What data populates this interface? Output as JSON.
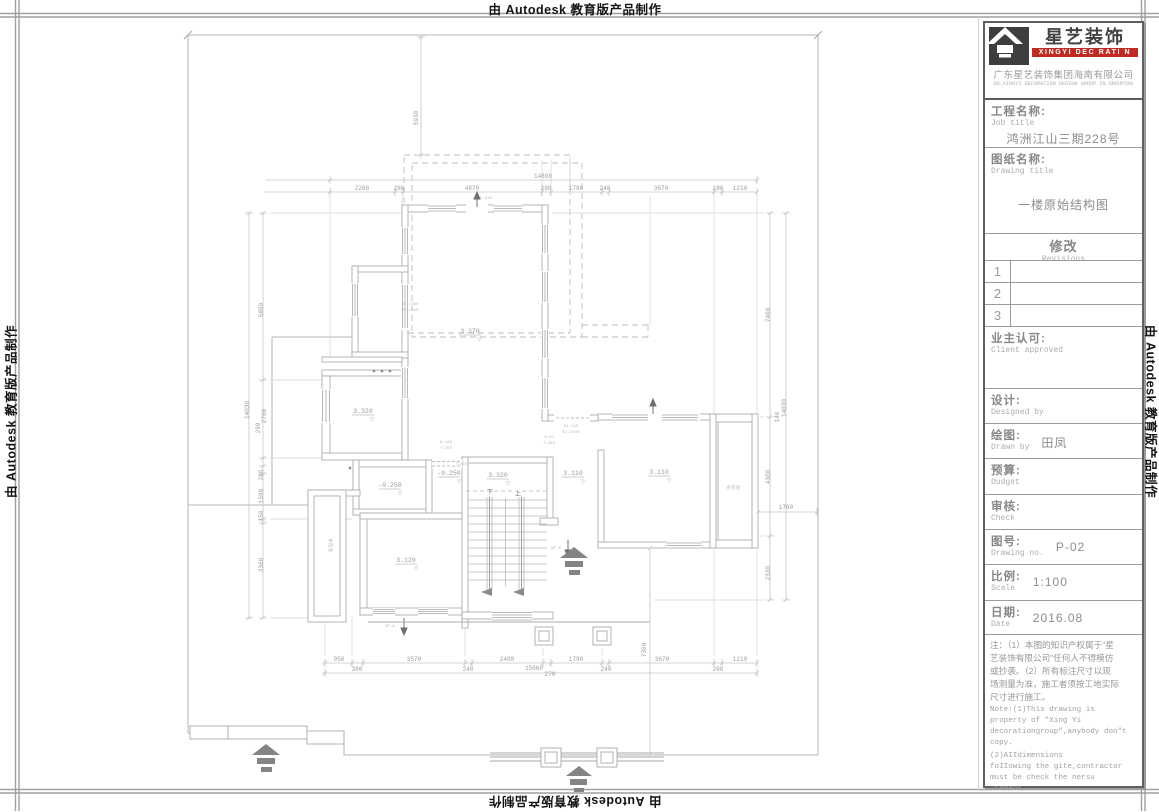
{
  "edge_marks": {
    "top": "由 Autodesk 教育版产品制作",
    "bottom": "由 Autodesk 教育版产品制作",
    "left": "由 Autodesk 教育版产品制作",
    "right": "由 Autodesk 教育版产品制作"
  },
  "colors": {
    "brand_red": "#bf2b23",
    "cad_line": "#b4b4b4",
    "dim_text": "#9c9c9c",
    "frame_dark": "#5f5f5f"
  },
  "title_block": {
    "logo": {
      "icon": "house-roof-icon",
      "brand_cn": "星艺装饰",
      "brand_en": "XINGYI DEC RATI N",
      "company_cn": "广东星艺装饰集团海南有限公司",
      "company_en": "GD.XINGYI DECORATION DESIGN GROUP IN.GROUPING"
    },
    "job": {
      "label_cn": "工程名称:",
      "label_en": "Job title",
      "value": "鸿洲江山三期228号"
    },
    "drawing": {
      "label_cn": "图纸名称:",
      "label_en": "Drawing title",
      "value": "一楼原始结构图"
    },
    "revisions": {
      "label_cn": "修改",
      "label_en": "Revisions",
      "rows": [
        "1",
        "2",
        "3"
      ]
    },
    "client": {
      "label_cn": "业主认可:",
      "label_en": "Client approved"
    },
    "designed": {
      "label_cn": "设计:",
      "label_en": "Designed by",
      "value": ""
    },
    "drawn": {
      "label_cn": "绘图:",
      "label_en": "Drawn by",
      "value": "田凤"
    },
    "budget": {
      "label_cn": "预算:",
      "label_en": "Dudget",
      "value": ""
    },
    "check": {
      "label_cn": "审核:",
      "label_en": "Check",
      "value": ""
    },
    "drawing_no": {
      "label_cn": "图号:",
      "label_en": "Drawing no.",
      "value": "P-02"
    },
    "scale": {
      "label_cn": "比例:",
      "label_en": "Scale",
      "value": "1:100"
    },
    "date": {
      "label_cn": "日期:",
      "label_en": "Date",
      "value": "2016.08"
    },
    "notes_cn": "注：（1）本图的知识产权属于\"星\n艺装饰有限公司\"任何人不得模仿\n或抄袭。（2）所有标注尺寸以现\n场测量为准，施工者须按工地实际\n尺寸进行施工。",
    "notes_en1": "Note:(1)This drawing is\nproperty of \"Xing Yi\ndecorationgroup\",anybody don\"t\ncopy.",
    "notes_en2": "    (2)AIIdimensions\nfoIIowing the gite,contractor\nmust be check the nersu\n-rement."
  },
  "plan": {
    "texts": [
      {
        "x": 543,
        "y": 178,
        "t": "14890"
      },
      {
        "x": 362,
        "y": 190,
        "t": "2260"
      },
      {
        "x": 399,
        "y": 190,
        "t": "280"
      },
      {
        "x": 472,
        "y": 190,
        "t": "4870"
      },
      {
        "x": 546,
        "y": 190,
        "t": "290"
      },
      {
        "x": 576,
        "y": 190,
        "t": "1790"
      },
      {
        "x": 605,
        "y": 190,
        "t": "240"
      },
      {
        "x": 661,
        "y": 190,
        "t": "3670"
      },
      {
        "x": 718,
        "y": 190,
        "t": "280"
      },
      {
        "x": 740,
        "y": 190,
        "t": "1210"
      },
      {
        "x": 339,
        "y": 661,
        "t": "950"
      },
      {
        "x": 414,
        "y": 661,
        "t": "3570"
      },
      {
        "x": 507,
        "y": 661,
        "t": "2480"
      },
      {
        "x": 576,
        "y": 661,
        "t": "1790"
      },
      {
        "x": 662,
        "y": 661,
        "t": "3670"
      },
      {
        "x": 740,
        "y": 661,
        "t": "1210"
      },
      {
        "x": 357,
        "y": 671,
        "t": "360"
      },
      {
        "x": 468,
        "y": 671,
        "t": "240"
      },
      {
        "x": 534,
        "y": 670,
        "t": "15060"
      },
      {
        "x": 550,
        "y": 676,
        "t": "270"
      },
      {
        "x": 606,
        "y": 671,
        "t": "240"
      },
      {
        "x": 718,
        "y": 671,
        "t": "280"
      },
      {
        "x": 249,
        "y": 410,
        "t": "14030",
        "r": -90
      },
      {
        "x": 263,
        "y": 310,
        "t": "5890",
        "r": -90
      },
      {
        "x": 266,
        "y": 416,
        "t": "2760",
        "r": -90
      },
      {
        "x": 260,
        "y": 428,
        "t": "290",
        "r": -90
      },
      {
        "x": 263,
        "y": 475,
        "t": "280",
        "r": -90
      },
      {
        "x": 263,
        "y": 496,
        "t": "1590",
        "r": -90
      },
      {
        "x": 263,
        "y": 516,
        "t": "150",
        "r": -90
      },
      {
        "x": 263,
        "y": 565,
        "t": "3360",
        "r": -90
      },
      {
        "x": 786,
        "y": 408,
        "t": "14030",
        "r": -90
      },
      {
        "x": 770,
        "y": 315,
        "t": "7400",
        "r": -90
      },
      {
        "x": 770,
        "y": 477,
        "t": "4300",
        "r": -90
      },
      {
        "x": 770,
        "y": 573,
        "t": "2330",
        "r": -90
      },
      {
        "x": 779,
        "y": 417,
        "t": "140",
        "r": -90
      },
      {
        "x": 786,
        "y": 509,
        "t": "1760"
      },
      {
        "x": 418,
        "y": 118,
        "t": "5930",
        "r": -90
      },
      {
        "x": 646,
        "y": 650,
        "t": "7300",
        "r": -90
      },
      {
        "x": 470,
        "y": 333,
        "t": "3.370",
        "c": "room"
      },
      {
        "x": 363,
        "y": 413,
        "t": "3.320",
        "c": "room"
      },
      {
        "x": 390,
        "y": 487,
        "t": "-0.250",
        "c": "room"
      },
      {
        "x": 449,
        "y": 475,
        "t": "-0.250",
        "c": "room"
      },
      {
        "x": 498,
        "y": 477,
        "t": "3.320",
        "c": "room"
      },
      {
        "x": 573,
        "y": 475,
        "t": "3.110",
        "c": "room"
      },
      {
        "x": 659,
        "y": 474,
        "t": "3.110",
        "c": "room"
      },
      {
        "x": 406,
        "y": 562,
        "t": "3.120",
        "c": "room"
      },
      {
        "x": 479,
        "y": 341,
        "t": "▽",
        "c": "tri"
      },
      {
        "x": 372,
        "y": 421,
        "t": "▽",
        "c": "tri"
      },
      {
        "x": 400,
        "y": 495,
        "t": "▽",
        "c": "tri"
      },
      {
        "x": 459,
        "y": 483,
        "t": "▽",
        "c": "tri"
      },
      {
        "x": 508,
        "y": 485,
        "t": "▽",
        "c": "tri"
      },
      {
        "x": 583,
        "y": 483,
        "t": "▽",
        "c": "tri"
      },
      {
        "x": 669,
        "y": 482,
        "t": "▽",
        "c": "tri"
      },
      {
        "x": 416,
        "y": 570,
        "t": "▽",
        "c": "tri"
      },
      {
        "x": 490,
        "y": 494,
        "t": "下",
        "c": "stair"
      },
      {
        "x": 518,
        "y": 496,
        "t": "上",
        "c": "stair"
      },
      {
        "x": 329,
        "y": 545,
        "t": "水花池",
        "c": "pool",
        "r": 90
      },
      {
        "x": 733,
        "y": 489,
        "t": "水花池",
        "c": "pool"
      },
      {
        "x": 410,
        "y": 305,
        "t": "H1:7360",
        "c": "tiny"
      },
      {
        "x": 410,
        "y": 311,
        "t": "H2:1360",
        "c": "tiny"
      },
      {
        "x": 571,
        "y": 427,
        "t": "K1:240",
        "c": "tiny"
      },
      {
        "x": 571,
        "y": 433,
        "t": "K2:2640",
        "c": "tiny"
      },
      {
        "x": 549,
        "y": 438,
        "t": "0:90",
        "c": "tiny"
      },
      {
        "x": 549,
        "y": 444,
        "t": "T:260",
        "c": "tiny"
      },
      {
        "x": 446,
        "y": 443,
        "t": "H:100",
        "c": "tiny"
      },
      {
        "x": 446,
        "y": 449,
        "t": "T:250",
        "c": "tiny"
      },
      {
        "x": 461,
        "y": 465,
        "t": "T:210",
        "c": "tiny"
      },
      {
        "x": 486,
        "y": 199,
        "t": "F:370",
        "c": "tiny"
      },
      {
        "x": 556,
        "y": 549,
        "t": "WT-A",
        "c": "tiny"
      },
      {
        "x": 390,
        "y": 627,
        "t": "WT-A",
        "c": "tiny"
      }
    ],
    "chains": [
      {
        "o": "h",
        "y": 180,
        "x1": 265,
        "x2": 758,
        "ticks": [
          330,
          757
        ]
      },
      {
        "o": "h",
        "y": 192,
        "x1": 265,
        "x2": 758,
        "ticks": [
          330,
          395,
          403,
          542,
          551,
          602,
          609,
          714,
          722,
          757
        ]
      },
      {
        "o": "h",
        "y": 663,
        "x1": 322,
        "x2": 758,
        "ticks": [
          325,
          352,
          363,
          465,
          472,
          543,
          551,
          602,
          609,
          714,
          722,
          757
        ]
      },
      {
        "o": "h",
        "y": 673,
        "x1": 322,
        "x2": 758,
        "ticks": [
          325,
          757
        ]
      },
      {
        "o": "v",
        "x": 263,
        "y1": 213,
        "y2": 618,
        "ticks": [
          213,
          380,
          458,
          466,
          474,
          519,
          523,
          618
        ]
      },
      {
        "o": "v",
        "x": 249,
        "y1": 213,
        "y2": 618,
        "ticks": [
          213,
          618
        ]
      },
      {
        "o": "v",
        "x": 770,
        "y1": 213,
        "y2": 600,
        "ticks": [
          213,
          417,
          536,
          600
        ]
      },
      {
        "o": "v",
        "x": 786,
        "y1": 213,
        "y2": 600,
        "ticks": [
          213,
          600
        ]
      },
      {
        "o": "h",
        "y": 512,
        "x1": 757,
        "x2": 818,
        "ticks": [
          758,
          817
        ]
      },
      {
        "o": "v",
        "x": 421,
        "y1": 37,
        "y2": 155,
        "ticks": [
          37,
          155
        ]
      },
      {
        "o": "v",
        "x": 650,
        "y1": 548,
        "y2": 755,
        "ticks": [
          548,
          755
        ]
      }
    ]
  }
}
